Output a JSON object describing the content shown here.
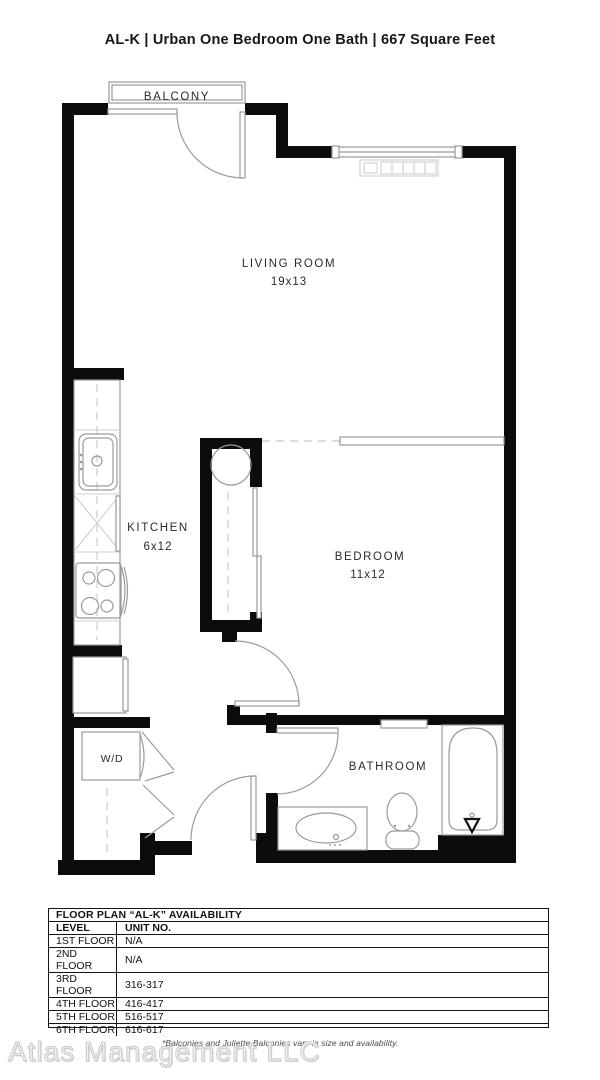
{
  "title": "AL-K | Urban One Bedroom One Bath | 667 Square Feet",
  "floor_plan": {
    "balcony_label": "BALCONY",
    "living_room_label": "LIVING ROOM",
    "living_room_dimensions": "19x13",
    "kitchen_label": "KITCHEN",
    "kitchen_dimensions": "6x12",
    "bedroom_label": "BEDROOM",
    "bedroom_dimensions": "11x12",
    "bathroom_label": "BATHROOM",
    "washer_dryer_label": "W/D",
    "colors": {
      "wall": "#0c0c0c",
      "fixture_line": "#9a9a9a",
      "light_line": "#cfcfcf"
    }
  },
  "availability_table": {
    "title": "FLOOR PLAN “AL-K” AVAILABILITY",
    "columns": [
      "LEVEL",
      "UNIT NO."
    ],
    "rows": [
      {
        "level": "1ST FLOOR",
        "unit_no": "N/A"
      },
      {
        "level": "2ND FLOOR",
        "unit_no": "N/A"
      },
      {
        "level": "3RD FLOOR",
        "unit_no": "316-317"
      },
      {
        "level": "4TH FLOOR",
        "unit_no": "416-417"
      },
      {
        "level": "5TH FLOOR",
        "unit_no": "516-517"
      },
      {
        "level": "6TH FLOOR",
        "unit_no": "616-617"
      }
    ]
  },
  "footer": {
    "watermark": "Atlas Management LLC",
    "disclaimer": "*Balconies and Juliette Balconies vary in size and availability."
  }
}
